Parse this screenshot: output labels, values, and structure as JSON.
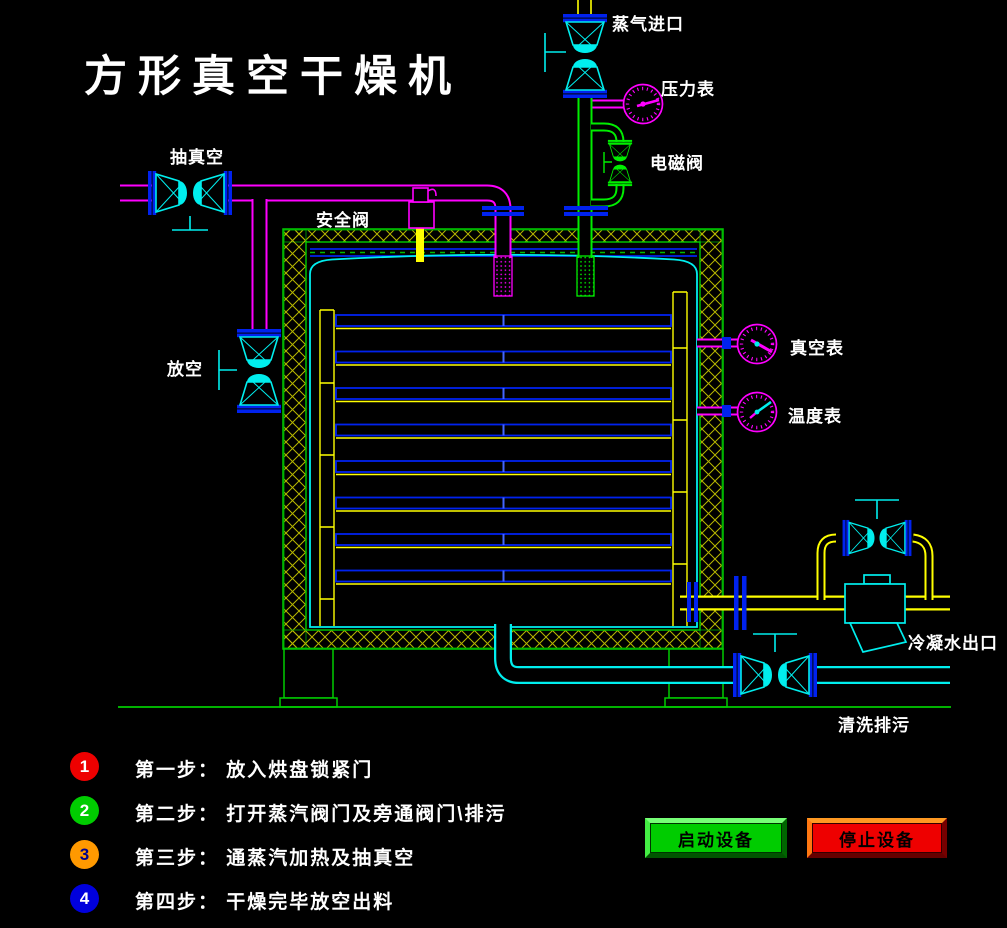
{
  "title": "方形真空干燥机",
  "diagram_labels": {
    "steam_inlet": "蒸气进口",
    "pressure_gauge": "压力表",
    "solenoid_valve": "电磁阀",
    "vacuum_suction": "抽真空",
    "safety_valve": "安全阀",
    "vent": "放空",
    "vacuum_gauge": "真空表",
    "temperature_gauge": "温度表",
    "condensate_outlet": "冷凝水出口",
    "flush_drain": "清洗排污"
  },
  "steps": [
    {
      "num": "1",
      "badge_color": "#ee0000",
      "num_color": "#ffffff",
      "text": "第一步： 放入烘盘锁紧门"
    },
    {
      "num": "2",
      "badge_color": "#00cc00",
      "num_color": "#ffffff",
      "text": "第二步： 打开蒸汽阀门及旁通阀门\\排污"
    },
    {
      "num": "3",
      "badge_color": "#ff9900",
      "num_color": "#00008b",
      "text": "第三步： 通蒸汽加热及抽真空"
    },
    {
      "num": "4",
      "badge_color": "#0000dd",
      "num_color": "#ffffff",
      "text": "第四步： 干燥完毕放空出料"
    }
  ],
  "buttons": {
    "start_label": "启动设备",
    "stop_label": "停止设备"
  },
  "colors": {
    "background": "#000000",
    "title_text": "#ffffff",
    "pipe_magenta": "#ff00ff",
    "pipe_green": "#00ee00",
    "pipe_cyan": "#00eeee",
    "pipe_yellow": "#ffff00",
    "flange_blue": "#0022ee",
    "insulation_hatch": "#b8b800",
    "vessel_border": "#00cc00"
  }
}
